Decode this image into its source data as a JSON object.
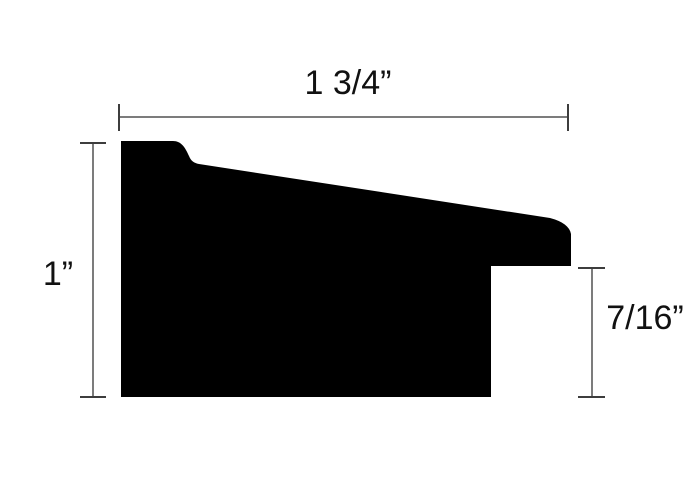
{
  "diagram": {
    "kind": "frame-moulding-cross-section"
  },
  "colors": {
    "background": "#ffffff",
    "profile_fill": "#000000",
    "dimension_line": "#7c7c7c",
    "dimension_tick": "#3d3d3d",
    "label_text": "#111111"
  },
  "profile": {
    "path": "M 121 141 L 173 141 C 181 141 185 147 189 156 C 191 161 194 163 199 164 L 550 218 Q 569 223 571 234 L 571 266 L 491 266 L 491 397 L 121 397 Z"
  },
  "dimensions": {
    "width": {
      "label": "1 3/4”",
      "value_inches": 1.75
    },
    "height": {
      "label": "1”",
      "value_inches": 1.0
    },
    "rabbet": {
      "label": "7/16”",
      "value_inches": 0.4375
    }
  }
}
